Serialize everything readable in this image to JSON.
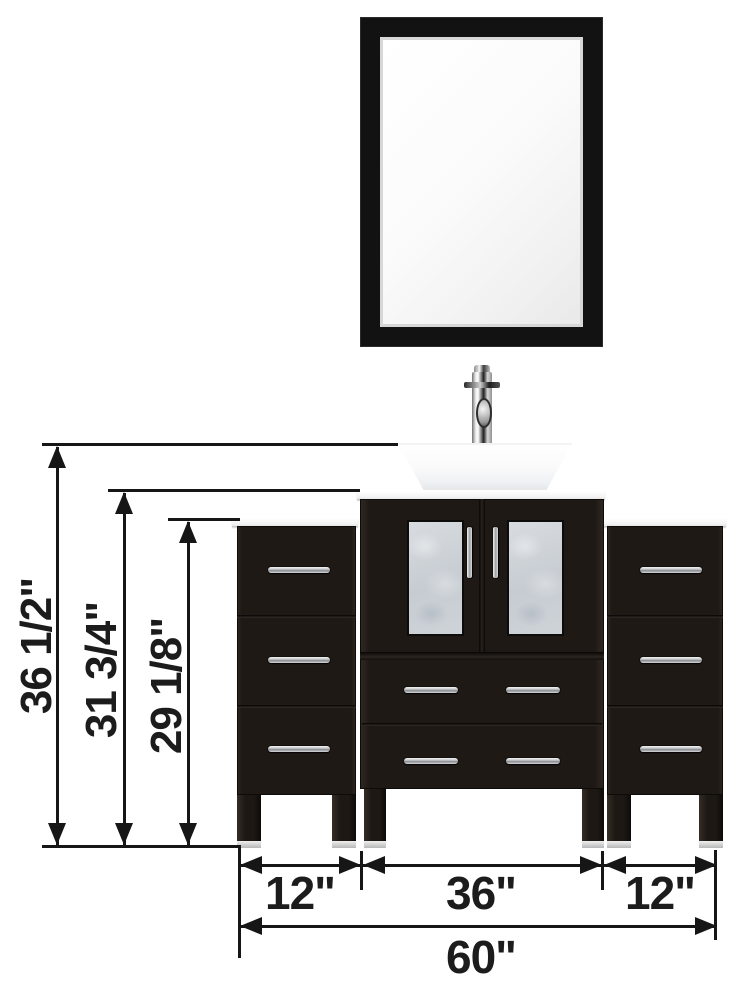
{
  "diagram": {
    "subject": "bathroom vanity set with mirror, vessel sink, faucet, center cabinet and two side cabinets",
    "units": "inches"
  },
  "dims": {
    "vertical": [
      {
        "id": "overall-height",
        "label": "36 1/2\""
      },
      {
        "id": "countertop-height",
        "label": "31 3/4\""
      },
      {
        "id": "side-cabinet-height",
        "label": "29 1/8\""
      }
    ],
    "horizontal": [
      {
        "id": "left-cabinet-width",
        "label": "12\""
      },
      {
        "id": "center-cabinet-width",
        "label": "36\""
      },
      {
        "id": "right-cabinet-width",
        "label": "12\""
      },
      {
        "id": "overall-width",
        "label": "60\""
      }
    ]
  },
  "colors": {
    "cabinet_espresso": "#1e1915",
    "mirror_frame": "#121212",
    "frosted_glass": "#ccd1d7",
    "chrome": "#d9dadc",
    "counter_white": "#f7f7f7",
    "dimension_ink": "#161616",
    "background": "#ffffff"
  }
}
